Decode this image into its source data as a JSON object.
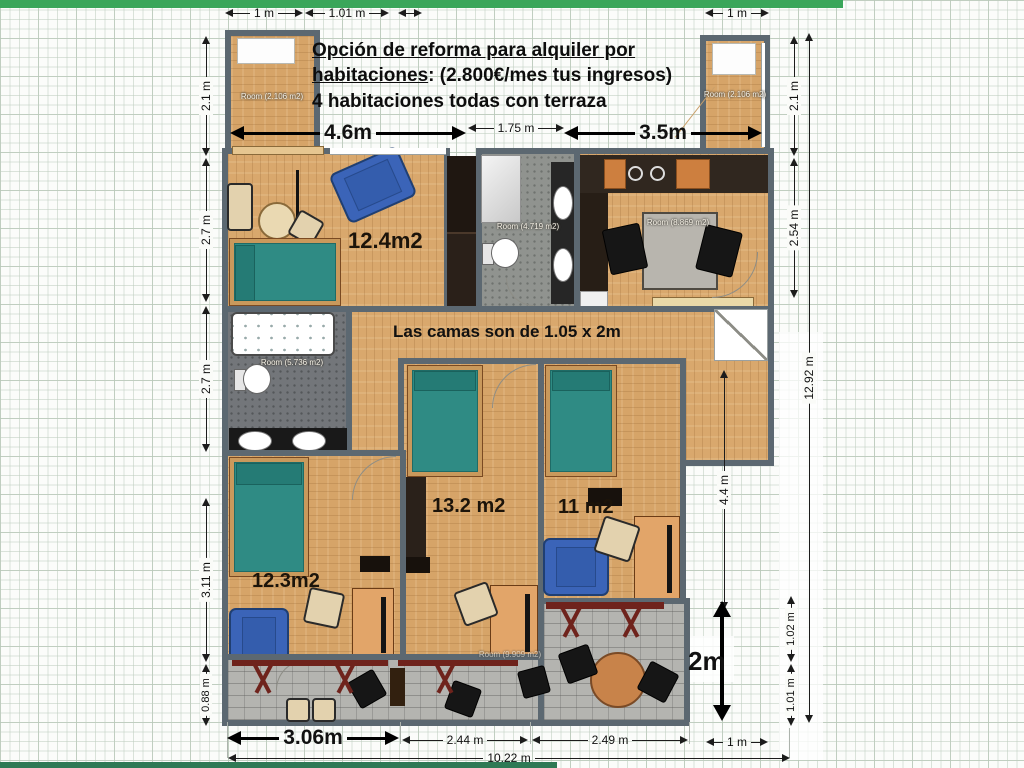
{
  "header": {
    "line1": "Opción de reforma para alquiler por",
    "line2_u": "habitaciones",
    "line2_rest": ": (2.800€/mes tus ingresos)",
    "line3": "4 habitaciones todas con terraza"
  },
  "note": {
    "beds": "Las camas son de 1.05 x 2m"
  },
  "rooms": {
    "bedroom_top_left": {
      "area": "12.4m2"
    },
    "bedroom_mid": {
      "area": "13.2 m2"
    },
    "bedroom_right": {
      "area": "11 m2"
    },
    "bedroom_bottom_left": {
      "area": "12.3m2"
    },
    "terrace_top_left": {
      "label": "Room (2.106 m2)"
    },
    "terrace_top_right": {
      "label": "Room (2.106 m2)"
    },
    "bathroom_top": {
      "label": "Room (4.719 m2)"
    },
    "kitchen": {
      "label": "Room (8.869 m2)"
    },
    "bathroom_mid": {
      "label": "Room (5.736 m2)"
    },
    "terrace_bottom": {
      "label": "Room (9.909 m2)"
    }
  },
  "dimensions": {
    "top_left_1m": "1 m",
    "top_left_101m": "1.01 m",
    "top_right_1m": "1 m",
    "width_46": "4.6m",
    "width_175": "1.75 m",
    "width_35": "3.5m",
    "left_21": "2.1 m",
    "left_27_upper": "2.7 m",
    "left_27_lower": "2.7 m",
    "left_311": "3.11 m",
    "left_088": "0.88 m",
    "right_21": "2.1 m",
    "right_254": "2.54 m",
    "right_1292": "12.92 m",
    "right_44": "4.4 m",
    "right_2m": "2m",
    "right_102": "1.02 m",
    "right_101": "1.01 m",
    "right_1m": "1 m",
    "bottom_306": "3.06m",
    "bottom_244": "2.44 m",
    "bottom_249": "2.49 m",
    "bottom_1022": "10.22 m"
  },
  "colors": {
    "accent_green": "#3aa65a",
    "footer_green": "#2f7a55",
    "wall": "#5c6871",
    "wood": "#d9a86d",
    "teal_bed": "#2f8b84",
    "blue_chair": "#3b64b8",
    "bath_floor": "#90938f",
    "terrace_red": "#6f231c"
  }
}
